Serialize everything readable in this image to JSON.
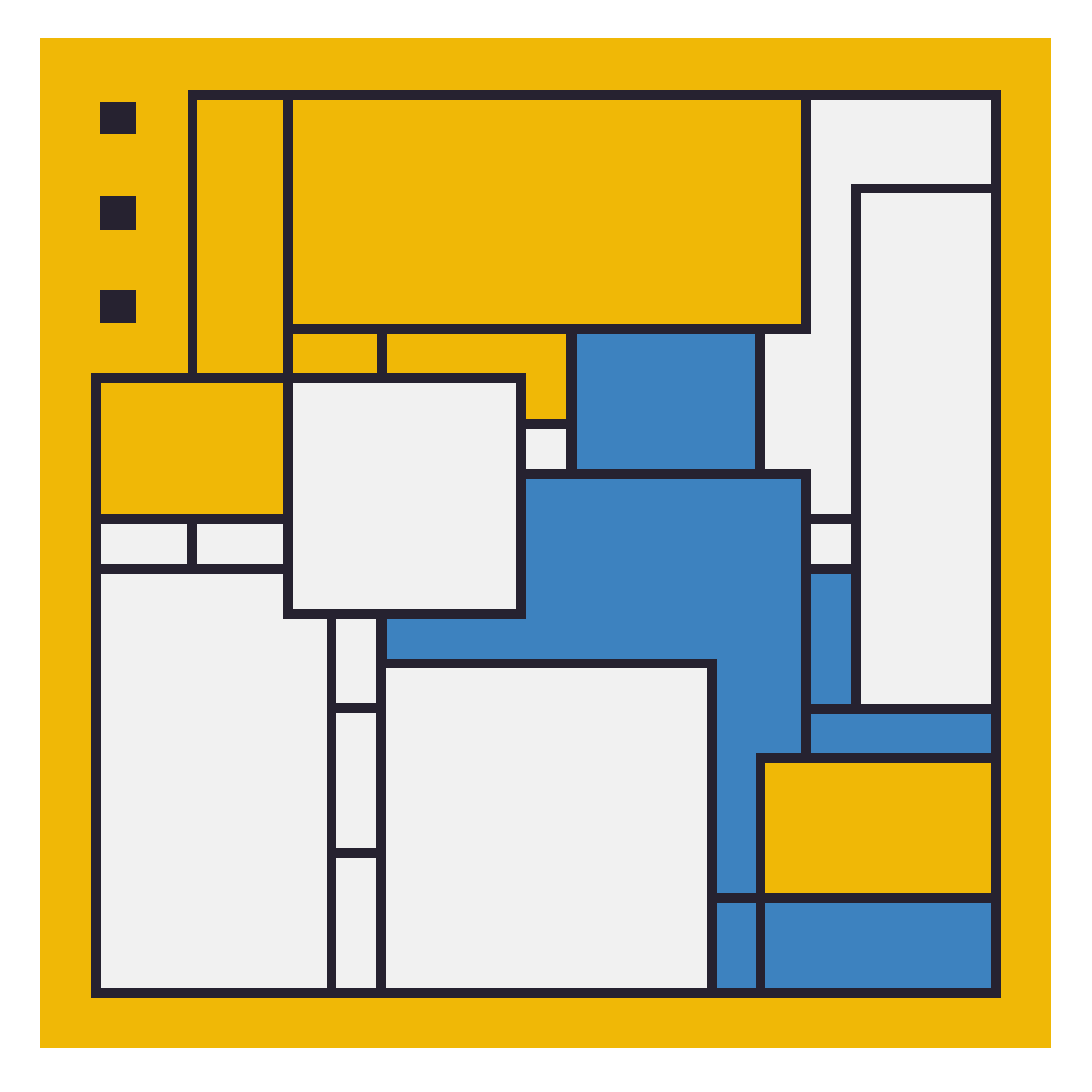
{
  "artwork": {
    "title": "Abstract geometric composition (Mondrian-style)",
    "colors": {
      "page_background": "#ffffff",
      "canvas_yellow": "#f0b806",
      "line_dark": "#262230",
      "cell_white": "#f1f1f1",
      "cell_blue": "#3d82bf",
      "cell_yellow": "#f0b806"
    },
    "canvas_rect": {
      "x": 40,
      "y": 38,
      "w": 1011,
      "h": 1010
    },
    "accent_squares": [
      {
        "name": "accent-square-1",
        "x": 100,
        "y": 102,
        "w": 36,
        "h": 32
      },
      {
        "name": "accent-square-2",
        "x": 100,
        "y": 196,
        "w": 36,
        "h": 34
      },
      {
        "name": "accent-square-3",
        "x": 100,
        "y": 290,
        "w": 36,
        "h": 33
      }
    ],
    "frame_rects": [
      {
        "name": "composition-frame-upper",
        "x": 188,
        "y": 90,
        "w": 813,
        "h": 908
      },
      {
        "name": "composition-frame-lower",
        "x": 91,
        "y": 373,
        "w": 106,
        "h": 625
      }
    ],
    "cells": [
      {
        "name": "yellow-column-tall",
        "color": "yellow",
        "x": 197,
        "y": 100,
        "w": 86,
        "h": 273
      },
      {
        "name": "yellow-banner",
        "color": "yellow",
        "x": 293,
        "y": 100,
        "w": 508,
        "h": 224
      },
      {
        "name": "yellow-band-left",
        "color": "yellow",
        "x": 293,
        "y": 334,
        "w": 84,
        "h": 39
      },
      {
        "name": "yellow-band-right",
        "color": "yellow",
        "x": 387,
        "y": 334,
        "w": 179,
        "h": 39
      },
      {
        "name": "yellow-tab",
        "color": "yellow",
        "x": 526,
        "y": 373,
        "w": 40,
        "h": 46
      },
      {
        "name": "yellow-block-left",
        "color": "yellow",
        "x": 101,
        "y": 383,
        "w": 182,
        "h": 131
      },
      {
        "name": "yellow-block-bottom-right",
        "color": "yellow",
        "x": 765,
        "y": 763,
        "w": 226,
        "h": 130
      },
      {
        "name": "white-square-center",
        "color": "white",
        "x": 293,
        "y": 383,
        "w": 223,
        "h": 226
      },
      {
        "name": "white-cell-small-left-1",
        "color": "white",
        "x": 101,
        "y": 524,
        "w": 86,
        "h": 40
      },
      {
        "name": "white-cell-small-left-2",
        "color": "white",
        "x": 197,
        "y": 524,
        "w": 86,
        "h": 40
      },
      {
        "name": "white-block-bottom-left",
        "color": "white",
        "x": 101,
        "y": 574,
        "w": 182,
        "h": 414
      },
      {
        "name": "white-block-bottom-left-ext",
        "color": "white",
        "x": 283,
        "y": 619,
        "w": 44,
        "h": 369
      },
      {
        "name": "white-cell-small-mid",
        "color": "white",
        "x": 526,
        "y": 429,
        "w": 40,
        "h": 40
      },
      {
        "name": "white-strip-cell-1",
        "color": "white",
        "x": 336,
        "y": 619,
        "w": 40,
        "h": 84
      },
      {
        "name": "white-strip-cell-2",
        "color": "white",
        "x": 336,
        "y": 713,
        "w": 40,
        "h": 135
      },
      {
        "name": "white-strip-cell-3",
        "color": "white",
        "x": 336,
        "y": 858,
        "w": 40,
        "h": 130
      },
      {
        "name": "white-block-bottom-center",
        "color": "white",
        "x": 386,
        "y": 668,
        "w": 321,
        "h": 320
      },
      {
        "name": "white-band-top-right",
        "color": "white",
        "x": 811,
        "y": 100,
        "w": 180,
        "h": 84
      },
      {
        "name": "white-column-right",
        "color": "white",
        "x": 811,
        "y": 184,
        "w": 40,
        "h": 330
      },
      {
        "name": "white-notch-right",
        "color": "white",
        "x": 765,
        "y": 334,
        "w": 46,
        "h": 135
      },
      {
        "name": "white-block-inner-right",
        "color": "white",
        "x": 861,
        "y": 193,
        "w": 130,
        "h": 511
      },
      {
        "name": "white-cell-small-right",
        "color": "white",
        "x": 811,
        "y": 524,
        "w": 40,
        "h": 40
      },
      {
        "name": "blue-block-top",
        "color": "blue",
        "x": 577,
        "y": 334,
        "w": 178,
        "h": 135
      },
      {
        "name": "blue-block-main",
        "color": "blue",
        "x": 526,
        "y": 479,
        "w": 275,
        "h": 180
      },
      {
        "name": "blue-band-center",
        "color": "blue",
        "x": 387,
        "y": 619,
        "w": 320,
        "h": 40
      },
      {
        "name": "blue-column-mid-upper",
        "color": "blue",
        "x": 717,
        "y": 659,
        "w": 84,
        "h": 94
      },
      {
        "name": "blue-column-mid-lower",
        "color": "blue",
        "x": 717,
        "y": 753,
        "w": 39,
        "h": 140
      },
      {
        "name": "blue-cell-bottom-small",
        "color": "blue",
        "x": 717,
        "y": 903,
        "w": 39,
        "h": 85
      },
      {
        "name": "blue-cell-right-column",
        "color": "blue",
        "x": 811,
        "y": 574,
        "w": 40,
        "h": 130
      },
      {
        "name": "blue-bar-right",
        "color": "blue",
        "x": 811,
        "y": 714,
        "w": 180,
        "h": 39
      },
      {
        "name": "blue-block-bottom-right",
        "color": "blue",
        "x": 765,
        "y": 903,
        "w": 226,
        "h": 85
      }
    ]
  }
}
